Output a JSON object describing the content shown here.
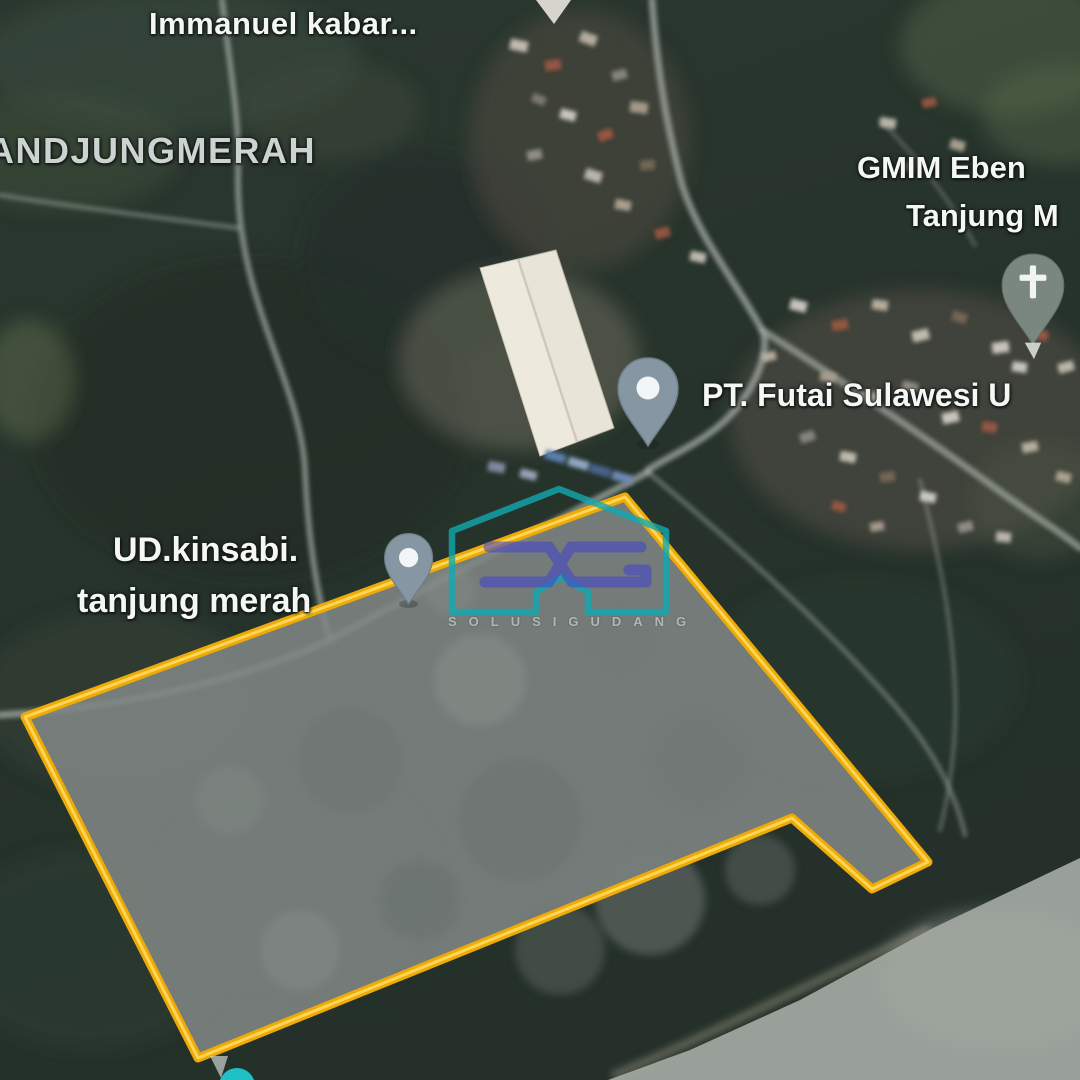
{
  "app": {
    "type": "satellite-map-view",
    "description": "Satellite imagery with land plot boundary overlay"
  },
  "labels": {
    "immanuel": "Immanuel kabar...",
    "locality": "ANDJUNGMERAH",
    "gmim_line1": "GMIM Eben",
    "gmim_line2": "Tanjung M",
    "futai": "PT. Futai Sulawesi U",
    "ud_line1": "UD.kinsabi.",
    "ud_line2": "tanjung merah"
  },
  "watermark": {
    "logo": "SG",
    "caption": "SOLUSIGUDANG"
  },
  "icons": {
    "place_pins": [
      "place-pin-icon (PT. Futai Sulawesi)",
      "place-pin-icon (UD.kinsabi tanjung merah)"
    ],
    "church_pin": "church-pin-icon (GMIM Eben Tanjung M)",
    "clipped_pin_top": "place-pin-tip-icon"
  },
  "colors": {
    "plot_boundary_yellow": "#eeab07",
    "plot_boundary_highlight": "#ffd95e",
    "pin_gray_blue": "#8796a3",
    "church_pin_gray_green": "#79877e",
    "watermark_teal": "#12a9b2",
    "watermark_indigo": "#4646c8",
    "teal_marker": "#1ec1c6",
    "beach_gray": "#99a099"
  }
}
